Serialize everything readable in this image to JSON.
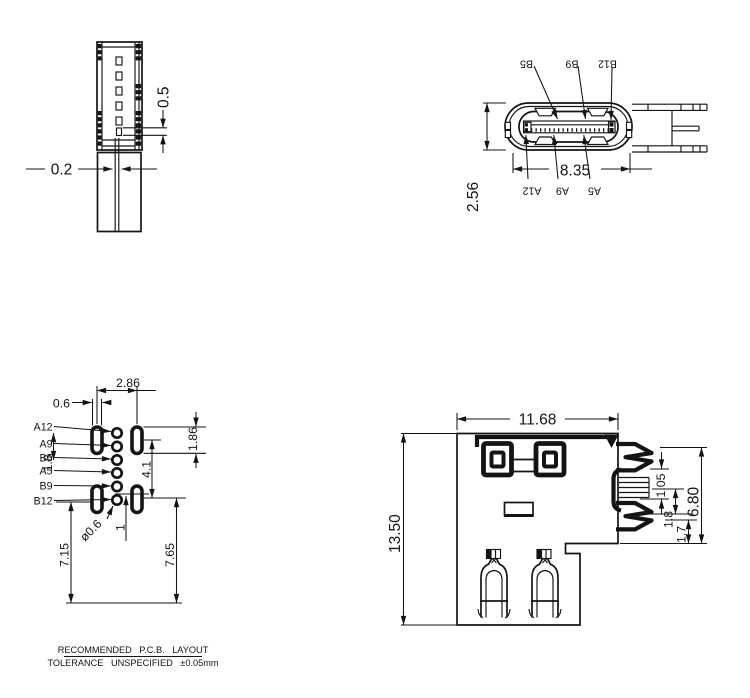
{
  "colors": {
    "line": "#141414",
    "background": "#ffffff"
  },
  "side_section_view": {
    "dim_pad_pitch": "0.5",
    "dim_slot_width": "0.2"
  },
  "front_face_view": {
    "dim_shell_width": "8.35",
    "dim_shell_height": "2.56",
    "top_pin_labels": [
      "B5",
      "B9",
      "B12"
    ],
    "bottom_pin_labels": [
      "A12",
      "A9",
      "A5"
    ]
  },
  "pcb_layout_view": {
    "pin_labels": [
      "A12",
      "A9",
      "B5",
      "A5",
      "B9",
      "B12"
    ],
    "dims": {
      "slot_pitch_x": "2.86",
      "slot_width": "0.6",
      "pin_row_spacing": "1.8",
      "slot_pitch_y": "4.1",
      "slot_height": "1.86",
      "hole_diameter": "ø0.6",
      "pin_offset": "1",
      "edge_left": "7.15",
      "edge_right": "7.65"
    }
  },
  "mount_side_view": {
    "dims": {
      "width": "11.68",
      "height": "13.50",
      "pin_a": "1.05",
      "pin_b": "1.8",
      "pin_c": "1.7",
      "pin_span": "6.80"
    }
  },
  "notes": {
    "line1": "RECOMMENDED P.C.B. LAYOUT",
    "line2": "TOLERANCE UNSPECIFIED ±0.05mm"
  }
}
